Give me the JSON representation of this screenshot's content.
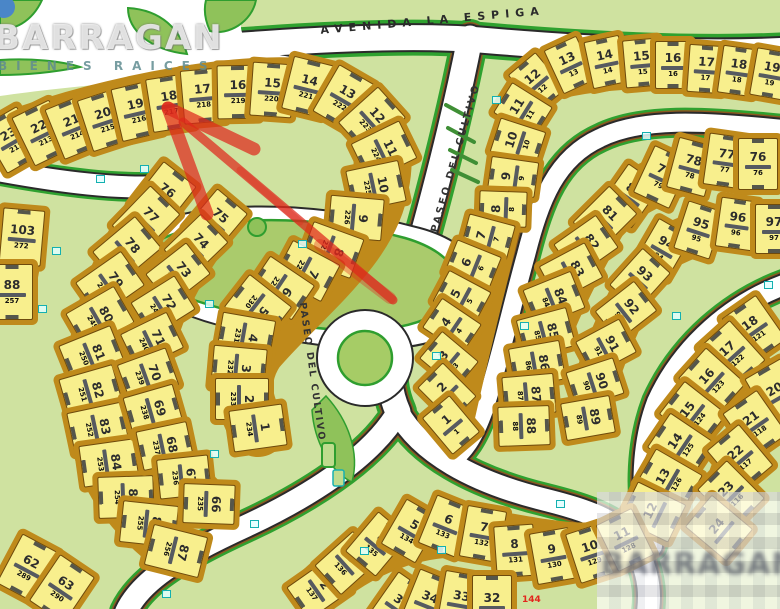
{
  "streets": {
    "avenida_la_espiga": "AVENIDA LA ESPIGA",
    "paseo_del_cultivo_right": "PASEO DEL CULTIVO",
    "paseo_del_cultivo_center": "PASEO DEL CULTIVO"
  },
  "watermark": {
    "brand": "BARRAGAN",
    "tagline": "BIENES RAICES"
  },
  "annotations": {
    "red_lot_ref": "144"
  },
  "colors": {
    "background": "#cfe2a0",
    "road": "#ffffff",
    "road_edge_green": "#2fa12f",
    "block_frame": "#bf8a1b",
    "lot_fill": "#f8ef8d",
    "lot_number": "#2d2d2d",
    "red_arrow": "#da261c",
    "marker_teal": "#14b0b0"
  },
  "blocks": [
    {
      "name": "top-left-arc",
      "w": 40,
      "h": 52,
      "lots": [
        [
          23,
          "212",
          12,
          140,
          -30
        ],
        [
          22,
          "213",
          42,
          133,
          -26
        ],
        [
          21,
          "214",
          74,
          127,
          -22
        ],
        [
          20,
          "215",
          105,
          120,
          -18
        ],
        [
          19,
          "216",
          137,
          111,
          -13
        ],
        [
          18,
          "217",
          170,
          103,
          -9
        ],
        [
          17,
          "218",
          203,
          96,
          -5
        ],
        [
          16,
          "219",
          238,
          92,
          -1
        ],
        [
          15,
          "220",
          272,
          90,
          4
        ],
        [
          14,
          "221",
          308,
          87,
          14
        ],
        [
          13,
          "222",
          344,
          98,
          30
        ],
        [
          12,
          "223",
          372,
          120,
          48
        ],
        [
          11,
          "224",
          384,
          151,
          64
        ],
        [
          10,
          "225",
          376,
          186,
          78
        ],
        [
          9,
          "226",
          356,
          218,
          95
        ],
        [
          8,
          "227",
          332,
          250,
          110
        ],
        [
          7,
          "228",
          307,
          271,
          118
        ],
        [
          6,
          "229",
          281,
          288,
          124
        ],
        [
          5,
          "230",
          258,
          307,
          128
        ],
        [
          4,
          "231",
          246,
          337,
          100
        ],
        [
          3,
          "232",
          239,
          368,
          95
        ],
        [
          2,
          "233",
          242,
          399,
          90
        ],
        [
          1,
          "234",
          258,
          428,
          82
        ]
      ]
    },
    {
      "name": "left-outer-arc",
      "w": 40,
      "h": 54,
      "lots": [
        [
          103,
          "272",
          22,
          237,
          5
        ],
        [
          88,
          "257",
          12,
          292,
          0
        ],
        [
          76,
          "245",
          163,
          196,
          38
        ],
        [
          77,
          "246",
          146,
          220,
          44
        ],
        [
          78,
          "247",
          127,
          250,
          50
        ],
        [
          79,
          "248",
          110,
          284,
          55
        ],
        [
          80,
          "249",
          100,
          318,
          60
        ],
        [
          81,
          "250",
          92,
          355,
          68
        ],
        [
          82,
          "251",
          91,
          392,
          74
        ],
        [
          83,
          "252",
          98,
          428,
          78
        ],
        [
          84,
          "253",
          109,
          463,
          82
        ],
        [
          85,
          "254",
          126,
          497,
          88
        ],
        [
          86,
          "255",
          149,
          524,
          96
        ],
        [
          87,
          "256",
          176,
          551,
          104
        ],
        [
          62,
          "289",
          28,
          568,
          28
        ],
        [
          63,
          "290",
          62,
          589,
          34
        ]
      ]
    },
    {
      "name": "left-inner-arc",
      "w": 38,
      "h": 50,
      "lots": [
        [
          75,
          "244",
          216,
          221,
          40
        ],
        [
          74,
          "243",
          196,
          246,
          46
        ],
        [
          73,
          "242",
          178,
          274,
          52
        ],
        [
          72,
          "241",
          163,
          306,
          58
        ],
        [
          71,
          "240",
          152,
          341,
          64
        ],
        [
          70,
          "239",
          148,
          375,
          70
        ],
        [
          69,
          "238",
          153,
          410,
          74
        ],
        [
          68,
          "237",
          165,
          446,
          78
        ],
        [
          67,
          "236",
          184,
          477,
          84
        ],
        [
          66,
          "235",
          209,
          504,
          92
        ]
      ]
    },
    {
      "name": "right-avenue-block",
      "w": 34,
      "h": 46,
      "lots": [
        [
          12,
          "12",
          537,
          82,
          -40
        ],
        [
          13,
          "13",
          570,
          65,
          -25
        ],
        [
          14,
          "14",
          606,
          62,
          -12
        ],
        [
          15,
          "15",
          642,
          63,
          -5
        ],
        [
          16,
          "16",
          673,
          65,
          0
        ],
        [
          17,
          "17",
          706,
          69,
          4
        ],
        [
          18,
          "18",
          738,
          71,
          8
        ],
        [
          19,
          "19",
          771,
          74,
          10
        ],
        [
          11,
          "11",
          523,
          110,
          -58
        ],
        [
          10,
          "10",
          518,
          142,
          -72
        ],
        [
          9,
          "9",
          513,
          177,
          -82
        ],
        [
          8,
          "8",
          503,
          209,
          -88
        ],
        [
          7,
          "7",
          488,
          237,
          -75
        ],
        [
          6,
          "6",
          473,
          265,
          -68
        ],
        [
          5,
          "5",
          462,
          297,
          -62
        ],
        [
          4,
          "4",
          452,
          326,
          -56
        ],
        [
          3,
          "3",
          449,
          360,
          -50
        ],
        [
          2,
          "2",
          447,
          392,
          -45
        ],
        [
          1,
          "1",
          451,
          425,
          -40
        ]
      ]
    },
    {
      "name": "right-middle-outer-arc",
      "w": 38,
      "h": 50,
      "lots": [
        [
          80,
          "80",
          630,
          196,
          35
        ],
        [
          79,
          "79",
          662,
          177,
          25
        ],
        [
          78,
          "78",
          692,
          167,
          15
        ],
        [
          77,
          "77",
          726,
          161,
          8
        ],
        [
          76,
          "76",
          758,
          164,
          0
        ],
        [
          81,
          "81",
          605,
          218,
          45
        ],
        [
          82,
          "82",
          586,
          246,
          55
        ],
        [
          83,
          "83",
          571,
          272,
          62
        ],
        [
          84,
          "84",
          554,
          299,
          68
        ],
        [
          85,
          "85",
          546,
          333,
          75
        ],
        [
          86,
          "86",
          537,
          364,
          80
        ],
        [
          87,
          "87",
          529,
          395,
          85
        ],
        [
          88,
          "88",
          524,
          426,
          88
        ]
      ]
    },
    {
      "name": "right-middle-inner-arc",
      "w": 36,
      "h": 48,
      "lots": [
        [
          94,
          "94",
          663,
          249,
          30
        ],
        [
          95,
          "95",
          699,
          230,
          18
        ],
        [
          96,
          "96",
          737,
          224,
          8
        ],
        [
          97,
          "97",
          774,
          229,
          0
        ],
        [
          93,
          "93",
          640,
          279,
          42
        ],
        [
          92,
          "92",
          626,
          311,
          52
        ],
        [
          91,
          "91",
          606,
          347,
          62
        ],
        [
          90,
          "90",
          595,
          383,
          72
        ],
        [
          89,
          "89",
          588,
          418,
          80
        ]
      ]
    },
    {
      "name": "bottom-right-block",
      "w": 40,
      "h": 52,
      "lots": [
        [
          18,
          "121",
          754,
          329,
          -35
        ],
        [
          17,
          "122",
          732,
          354,
          -42
        ],
        [
          16,
          "123",
          712,
          381,
          -48
        ],
        [
          15,
          "124",
          693,
          414,
          -52
        ],
        [
          14,
          "125",
          681,
          445,
          -56
        ],
        [
          13,
          "126",
          669,
          480,
          -60
        ],
        [
          12,
          "",
          653,
          512,
          -64
        ],
        [
          20,
          "",
          776,
          392,
          -30
        ],
        [
          21,
          "118",
          755,
          424,
          -35
        ],
        [
          22,
          "117",
          740,
          458,
          -40
        ],
        [
          23,
          "116",
          731,
          494,
          -45
        ],
        [
          24,
          "",
          719,
          528,
          -50
        ]
      ]
    },
    {
      "name": "bottom-middle-fan",
      "w": 38,
      "h": 50,
      "lots": [
        [
          2,
          "137",
          319,
          589,
          55
        ],
        [
          3,
          "136",
          347,
          563,
          48
        ],
        [
          4,
          "135",
          377,
          544,
          40
        ],
        [
          5,
          "134",
          411,
          531,
          30
        ],
        [
          6,
          "133",
          446,
          526,
          22
        ],
        [
          7,
          "132",
          483,
          534,
          10
        ],
        [
          8,
          "131",
          515,
          551,
          -4
        ],
        [
          9,
          "130",
          553,
          556,
          -10
        ],
        [
          10,
          "129",
          592,
          553,
          -18
        ],
        [
          11,
          "128",
          625,
          540,
          -26
        ],
        [
          35,
          "",
          400,
          604,
          35
        ],
        [
          34,
          "",
          429,
          600,
          22
        ],
        [
          33,
          "",
          461,
          599,
          10
        ],
        [
          32,
          "",
          492,
          601,
          0
        ]
      ]
    }
  ],
  "markers": [
    [
      52,
      247
    ],
    [
      38,
      305
    ],
    [
      140,
      165
    ],
    [
      205,
      300
    ],
    [
      210,
      450
    ],
    [
      250,
      520
    ],
    [
      437,
      546
    ],
    [
      556,
      500
    ],
    [
      432,
      352
    ],
    [
      298,
      240
    ],
    [
      492,
      96
    ],
    [
      642,
      132
    ],
    [
      672,
      312
    ],
    [
      162,
      590
    ],
    [
      520,
      322
    ],
    [
      764,
      281
    ],
    [
      360,
      547
    ],
    [
      96,
      175
    ]
  ]
}
